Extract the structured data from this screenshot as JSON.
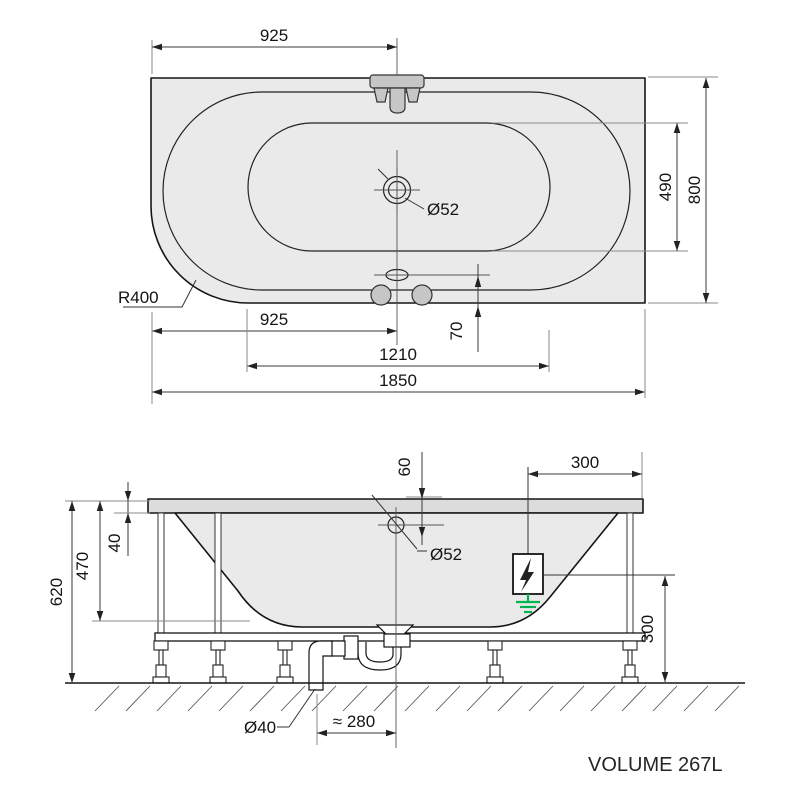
{
  "footer": {
    "volume": "VOLUME 267L"
  },
  "colors": {
    "line": "#151515",
    "body_fill": "#eaeaea",
    "metal_fill": "#c6c6c6",
    "ground_green": "#00b34d"
  },
  "top_view": {
    "dim_faucet_offset": "925",
    "dim_overall_width": "800",
    "dim_basin_width": "490",
    "corner_radius": "R400",
    "dim_drain_offset": "925",
    "dim_basin_length": "1210",
    "dim_overall_length": "1850",
    "dim_overflow_edge": "70",
    "drain_diameter": "Ø52"
  },
  "side_view": {
    "dim_overflow_top": "60",
    "dim_frame_inset": "300",
    "dim_rim_height": "40",
    "dim_depth": "470",
    "dim_total_height": "620",
    "dim_frame_height": "300",
    "overflow_diameter": "Ø52",
    "pipe_diameter": "Ø40",
    "dim_trap_offset": "≈ 280"
  }
}
